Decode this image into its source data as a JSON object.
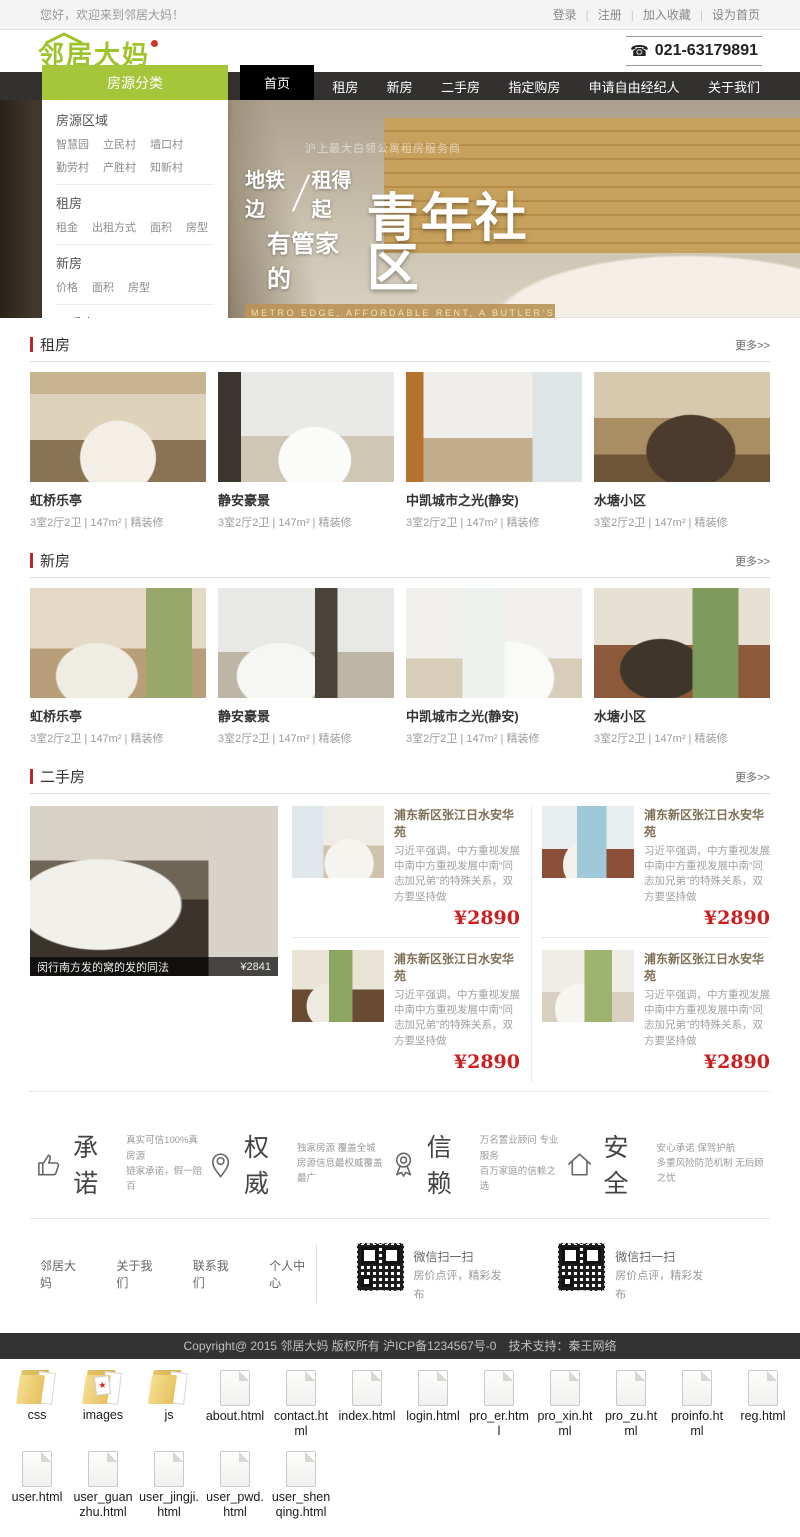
{
  "topbar": {
    "welcome": "您好，欢迎来到邻居大妈！",
    "links": [
      "登录",
      "注册",
      "加入收藏",
      "设为首页"
    ]
  },
  "header": {
    "logo": "邻居大妈",
    "phone": "021-63179891",
    "phone_icon": "phone-icon"
  },
  "nav": {
    "category_label": "房源分类",
    "items": [
      {
        "label": "首页",
        "state": "active"
      },
      {
        "label": "租房"
      },
      {
        "label": "新房"
      },
      {
        "label": "二手房"
      },
      {
        "label": "指定购房"
      },
      {
        "label": "申请自由经纪人"
      },
      {
        "label": "关于我们"
      }
    ]
  },
  "dropdown": {
    "groups": [
      {
        "title": "房源区域",
        "items": [
          {
            "t": "智慧园"
          },
          {
            "t": "立民村"
          },
          {
            "t": "墙口村"
          },
          {
            "t": "勤劳村"
          },
          {
            "t": "产胜村"
          },
          {
            "t": "知新村"
          }
        ]
      },
      {
        "title": "租房",
        "items": [
          {
            "t": "租金"
          },
          {
            "t": "出租方式"
          },
          {
            "t": "面积"
          },
          {
            "t": "房型"
          }
        ]
      },
      {
        "title": "新房",
        "items": [
          {
            "t": "价格"
          },
          {
            "t": "面积"
          },
          {
            "t": "房型"
          }
        ]
      },
      {
        "title": "二手房",
        "items": [
          {
            "t": "价格"
          },
          {
            "t": "面积"
          },
          {
            "t": "房型"
          }
        ]
      }
    ]
  },
  "hero": {
    "tagline_small": "沪上最大白领公寓租房服务商",
    "line1_a": "地铁边",
    "line1_b": "租得起",
    "line2": "有管家的",
    "big": "青年社区",
    "en_band": "METRO EDGE, AFFORDABLE RENT, A BUTLER'S YOUTH COMMUNITY",
    "accent_color": "#b9925a"
  },
  "sections": {
    "zufang": {
      "title": "租房",
      "more": "更多>>",
      "cards": [
        {
          "name": "虹桥乐亭",
          "meta": "3室2厅2卫 | 147m² | 精装修",
          "photo": "p1"
        },
        {
          "name": "静安豪景",
          "meta": "3室2厅2卫 | 147m² | 精装修",
          "photo": "p2"
        },
        {
          "name": "中凯城市之光(静安)",
          "meta": "3室2厅2卫 | 147m² | 精装修",
          "photo": "p3"
        },
        {
          "name": "水塘小区",
          "meta": "3室2厅2卫 | 147m² | 精装修",
          "photo": "p4"
        }
      ]
    },
    "xinfang": {
      "title": "新房",
      "more": "更多>>",
      "cards": [
        {
          "name": "虹桥乐亭",
          "meta": "3室2厅2卫 | 147m² | 精装修",
          "photo": "p5"
        },
        {
          "name": "静安豪景",
          "meta": "3室2厅2卫 | 147m² | 精装修",
          "photo": "p6"
        },
        {
          "name": "中凯城市之光(静安)",
          "meta": "3室2厅2卫 | 147m² | 精装修",
          "photo": "p7"
        },
        {
          "name": "水塘小区",
          "meta": "3室2厅2卫 | 147m² | 精装修",
          "photo": "p8"
        }
      ]
    },
    "ershou": {
      "title": "二手房",
      "more": "更多>>",
      "feature": {
        "caption": "闵行南方发的窝的发的同法",
        "price": "¥2841",
        "photo": "big"
      },
      "cards": [
        {
          "title": "浦东新区张江日水安华苑",
          "desc": "习近平强调，中方重视发展中南中方重视发展中南“同志加兄弟”的特殊关系，双方要坚持做",
          "price": "¥2890",
          "photo": "e1"
        },
        {
          "title": "浦东新区张江日水安华苑",
          "desc": "习近平强调，中方重视发展中南中方重视发展中南“同志加兄弟”的特殊关系，双方要坚持做",
          "price": "¥2890",
          "photo": "e2"
        },
        {
          "title": "浦东新区张江日水安华苑",
          "desc": "习近平强调，中方重视发展中南中方重视发展中南“同志加兄弟”的特殊关系，双方要坚持做",
          "price": "¥2890",
          "photo": "e3"
        },
        {
          "title": "浦东新区张江日水安华苑",
          "desc": "习近平强调，中方重视发展中南中方重视发展中南“同志加兄弟”的特殊关系，双方要坚持做",
          "price": "¥2890",
          "photo": "e4"
        }
      ]
    }
  },
  "features": [
    {
      "title": "承诺",
      "line1": "真实可信100%真房源",
      "line2": "链家承诺，假一赔百",
      "icon": "thumb-up-icon"
    },
    {
      "title": "权威",
      "line1": "独家房源 覆盖全城",
      "line2": "房源信息最权威覆盖最广",
      "icon": "location-pin-icon"
    },
    {
      "title": "信赖",
      "line1": "万名置业顾问 专业服务",
      "line2": "百万家庭的信赖之选",
      "icon": "medal-icon"
    },
    {
      "title": "安全",
      "line1": "安心承诺 保驾护航",
      "line2": "多重风险防范机制 无后顾之忧",
      "icon": "house-icon"
    }
  ],
  "footer": {
    "links": [
      "邻居大妈",
      "关于我们",
      "联系我们",
      "个人中心"
    ],
    "qr_blocks": [
      {
        "line1": "微信扫一扫",
        "line2": "房价点评，精彩发布"
      },
      {
        "line1": "微信扫一扫",
        "line2": "房价点评，精彩发布"
      }
    ],
    "copyright": "Copyright@ 2015 邻居大妈 版权所有 沪ICP备1234567号-0　技术支持：秦王网络"
  },
  "files": {
    "row1": [
      {
        "name": "css",
        "type": "folder"
      },
      {
        "name": "images",
        "type": "folder-images"
      },
      {
        "name": "js",
        "type": "folder"
      },
      {
        "name": "about.html",
        "type": "file"
      },
      {
        "name": "contact.html",
        "type": "file"
      },
      {
        "name": "index.html",
        "type": "file"
      },
      {
        "name": "login.html",
        "type": "file"
      },
      {
        "name": "pro_er.html",
        "type": "file"
      },
      {
        "name": "pro_xin.html",
        "type": "file"
      },
      {
        "name": "pro_zu.html",
        "type": "file"
      },
      {
        "name": "proinfo.html",
        "type": "file"
      },
      {
        "name": "reg.html",
        "type": "file"
      }
    ],
    "row2": [
      {
        "name": "user.html",
        "type": "file"
      },
      {
        "name": "user_guanzhu.html",
        "type": "file"
      },
      {
        "name": "user_jingji.html",
        "type": "file"
      },
      {
        "name": "user_pwd.html",
        "type": "file"
      },
      {
        "name": "user_shenqing.html",
        "type": "file"
      }
    ]
  }
}
